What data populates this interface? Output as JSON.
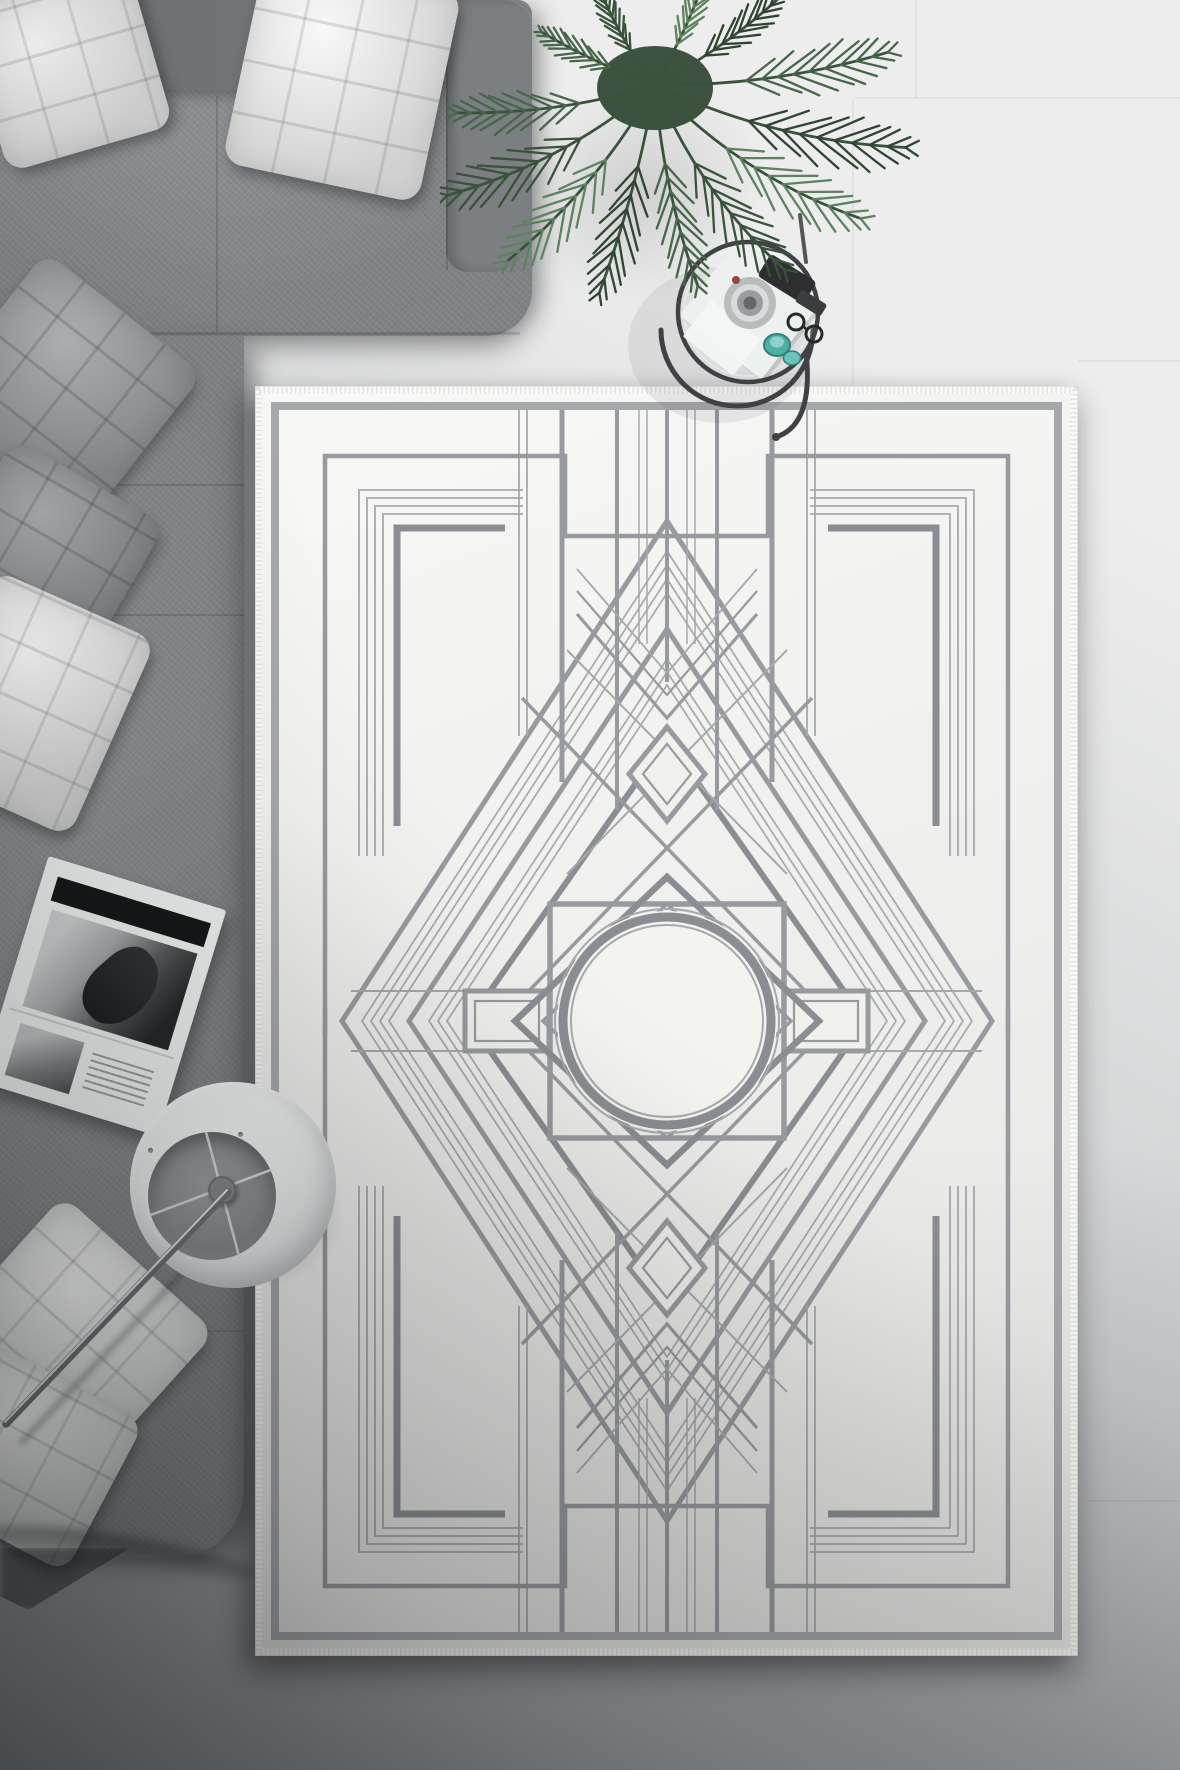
{
  "scene": {
    "description": "Top-down product photo of a living room corner: a gray L-shaped sectional sofa with quilted pillows, an areca palm plant, a round metal-frame side table with a camera and teal glasses, an open magazine, a white drum-shade floor lamp, and a large cream art-deco geometric area rug on a light gray tile floor.",
    "objects": {
      "rug": {
        "label": "Cream art-deco area rug",
        "pattern": "concentric diamonds, central circle medallion, eight-point star frame, stepped corner angles, chevron lattice",
        "shape": "rectangle"
      },
      "sofa": {
        "label": "Gray sectional sofa",
        "pillows_white": 5,
        "pillows_gray": 2
      },
      "plant": {
        "label": "Areca palm plant"
      },
      "side_table": {
        "label": "Round metal side table",
        "items": [
          "camera",
          "sunglasses",
          "teal glass cups",
          "white tray"
        ]
      },
      "magazine": {
        "label": "Open magazine with black-and-white photos"
      },
      "floor_lamp": {
        "label": "White drum-shade floor lamp with metal pole"
      },
      "floor": {
        "label": "Light gray tile floor"
      }
    }
  },
  "theme": {
    "colors": {
      "floor_light": "#ededed",
      "floor_mid": "#d6d8d9",
      "floor_dark": "#a2a5a7",
      "floor_darker": "#8e9193",
      "sofa": "#85888b",
      "sofa_dark": "#717477",
      "sofa_dark2": "#7c7f82",
      "pillow_white": "#eff0ee",
      "pillow_gray": "#9fa1a3",
      "paper": "#f4f5f5",
      "ink": "#141516",
      "rug_bg": "#f0f0ed",
      "rug_bg2": "#f3f3f0",
      "rug_band": "#a6a9ac",
      "rug_line": "#979a9e",
      "rug_line_thin": "#a6a9ac",
      "rug_line_dark": "#8a8d91",
      "fringe": "#f9f9f7",
      "plant_dark": "#2f4431",
      "plant_mid": "#47664a",
      "plant_light": "#5e8260",
      "plant_stem": "#3a523c",
      "metal_dark": "#3f4144",
      "silver": "#c4c6c8",
      "teal": "#4fb0a5",
      "teal_dark": "#2e8078",
      "lamp": "#f0f1f1",
      "lamp_edge": "#c9cccd",
      "lamp_inner": "#8a8d90",
      "hub": "#85888b"
    }
  }
}
